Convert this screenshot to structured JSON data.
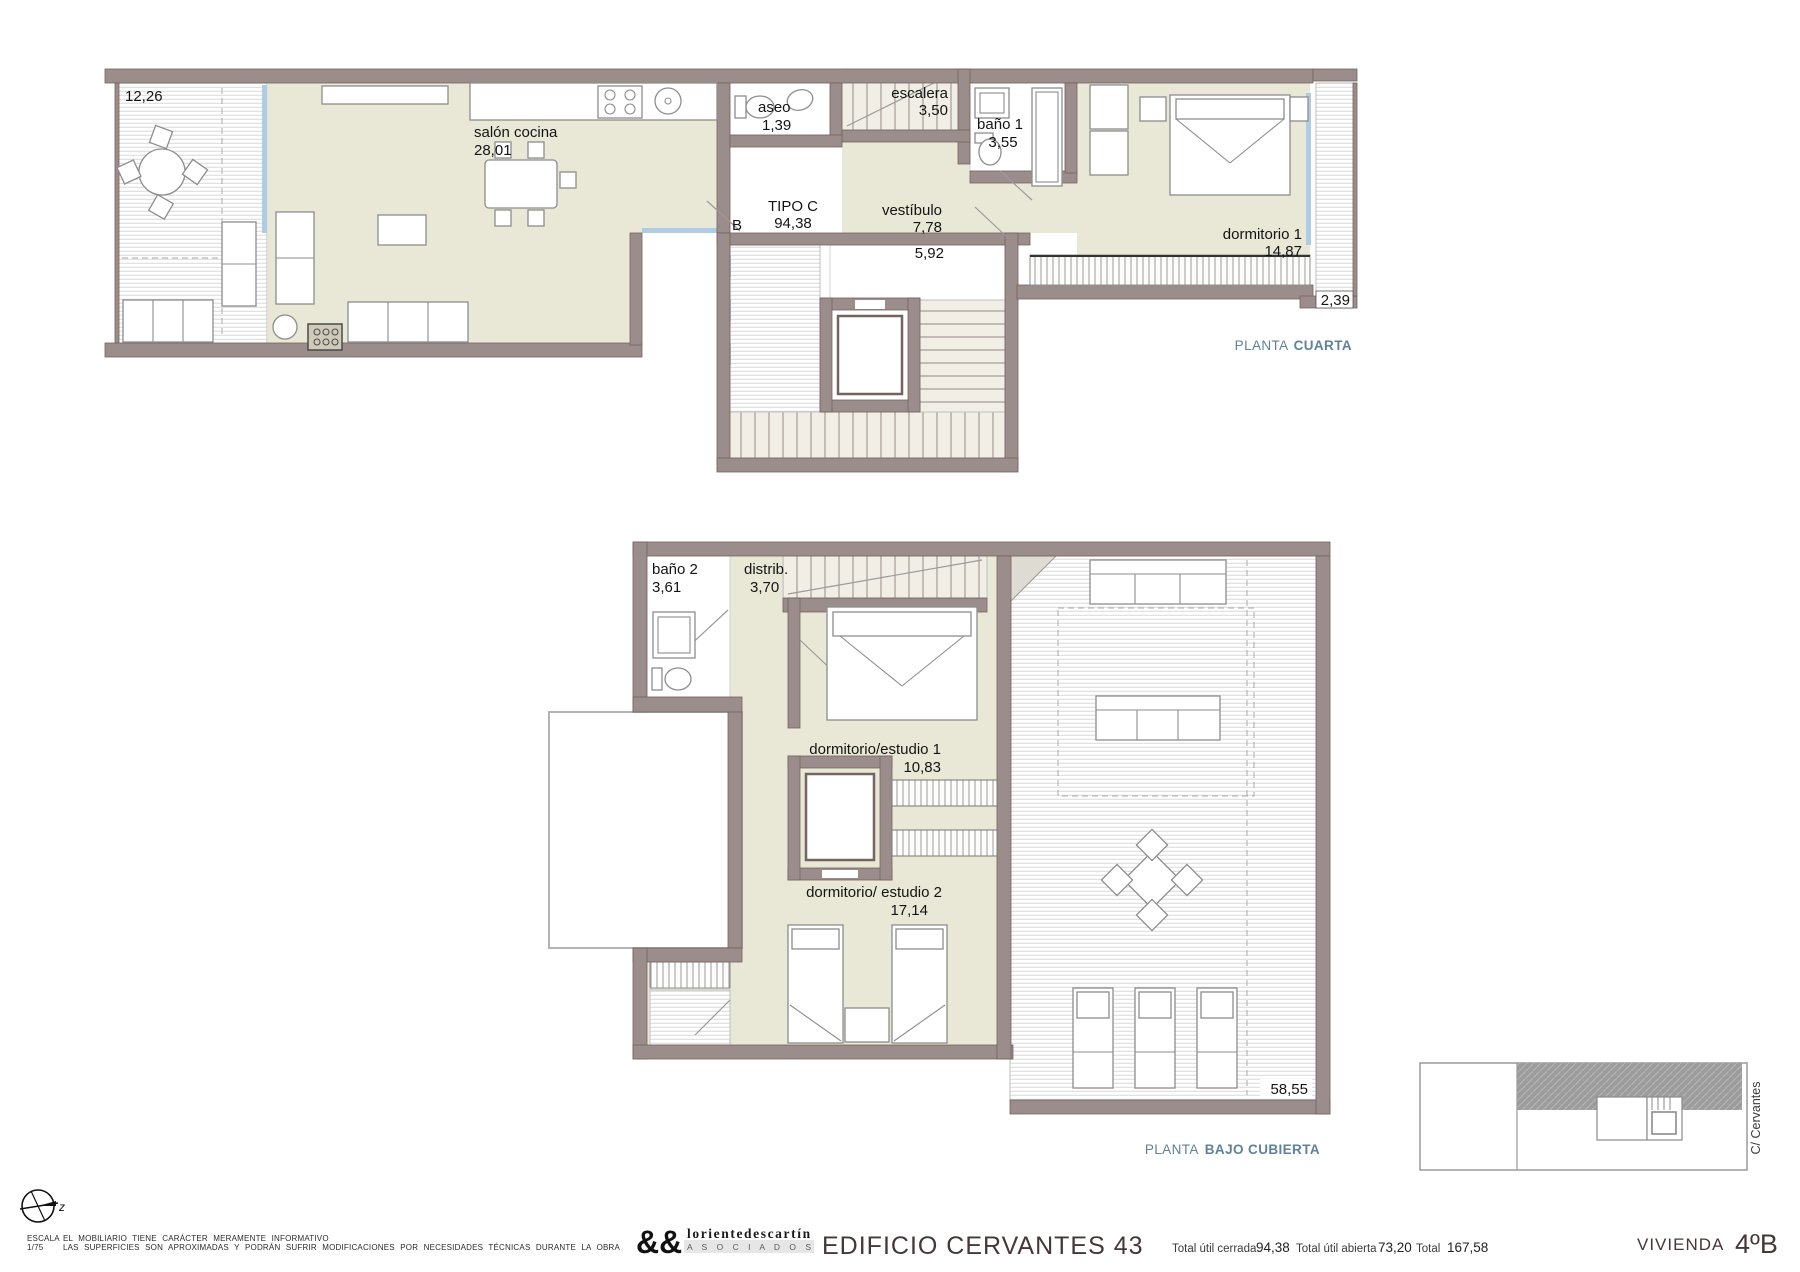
{
  "document": {
    "plans": {
      "cuarta": {
        "caption_prefix": "PLANTA",
        "caption_name": "CUARTA",
        "labels": {
          "terrace_left_area": "12,26",
          "salon_name": "salón cocina",
          "salon_area": "28,01",
          "aseo_name": "aseo",
          "aseo_area": "1,39",
          "escalera_name": "escalera",
          "escalera_area": "3,50",
          "bano1_name": "baño 1",
          "bano1_area": "3,55",
          "tipo_name": "TIPO C",
          "tipo_area": "94,38",
          "door_letter": "B",
          "vestibulo_name": "vestíbulo",
          "vestibulo_area": "7,78",
          "landing_area": "5,92",
          "dormitorio1_name": "dormitorio 1",
          "dormitorio1_area": "14,87",
          "terrace_right_area": "2,39"
        }
      },
      "bajo_cubierta": {
        "caption_prefix": "PLANTA",
        "caption_name": "BAJO CUBIERTA",
        "labels": {
          "bano2_name": "baño 2",
          "bano2_area": "3,61",
          "distrib_name": "distrib.",
          "distrib_area": "3,70",
          "dormitorio_estudio1_name": "dormitorio/estudio 1",
          "dormitorio_estudio1_area": "10,83",
          "dormitorio_estudio2_name": "dormitorio/ estudio 2",
          "dormitorio_estudio2_area": "17,14",
          "roof_terrace_area": "58,55"
        }
      }
    },
    "site_key": {
      "street_label": "C/ Cervantes"
    },
    "footer": {
      "north_letter": "z",
      "scale_label": "ESCALA",
      "scale_value": "1/75",
      "disclaimer_line1": "EL MOBILIARIO TIENE CARÁCTER MERAMENTE INFORMATIVO",
      "disclaimer_line2": "LAS SUPERFICIES SON APROXIMADAS Y PODRÁN SUFRIR MODIFICACIONES POR NECESIDADES TÉCNICAS DURANTE LA OBRA",
      "logo_ampersands": "&&",
      "logo_name": "lorientedescartín",
      "logo_subtitle": "A S O C I A D O S",
      "project_title": "EDIFICIO CERVANTES 43",
      "totals": [
        {
          "label": "Total útil cerrada",
          "value": "94,38"
        },
        {
          "label": "Total útil abierta",
          "value": "73,20"
        },
        {
          "label": "Total",
          "value": "167,58"
        }
      ],
      "unit_label": "VIVIENDA",
      "unit_value": "4ºB"
    },
    "colors": {
      "wall": "#9b8d8b",
      "floor": "#e9e8d6",
      "window": "#aecde4",
      "caption_accent": "#5f8299",
      "title_text": "#463738"
    }
  }
}
